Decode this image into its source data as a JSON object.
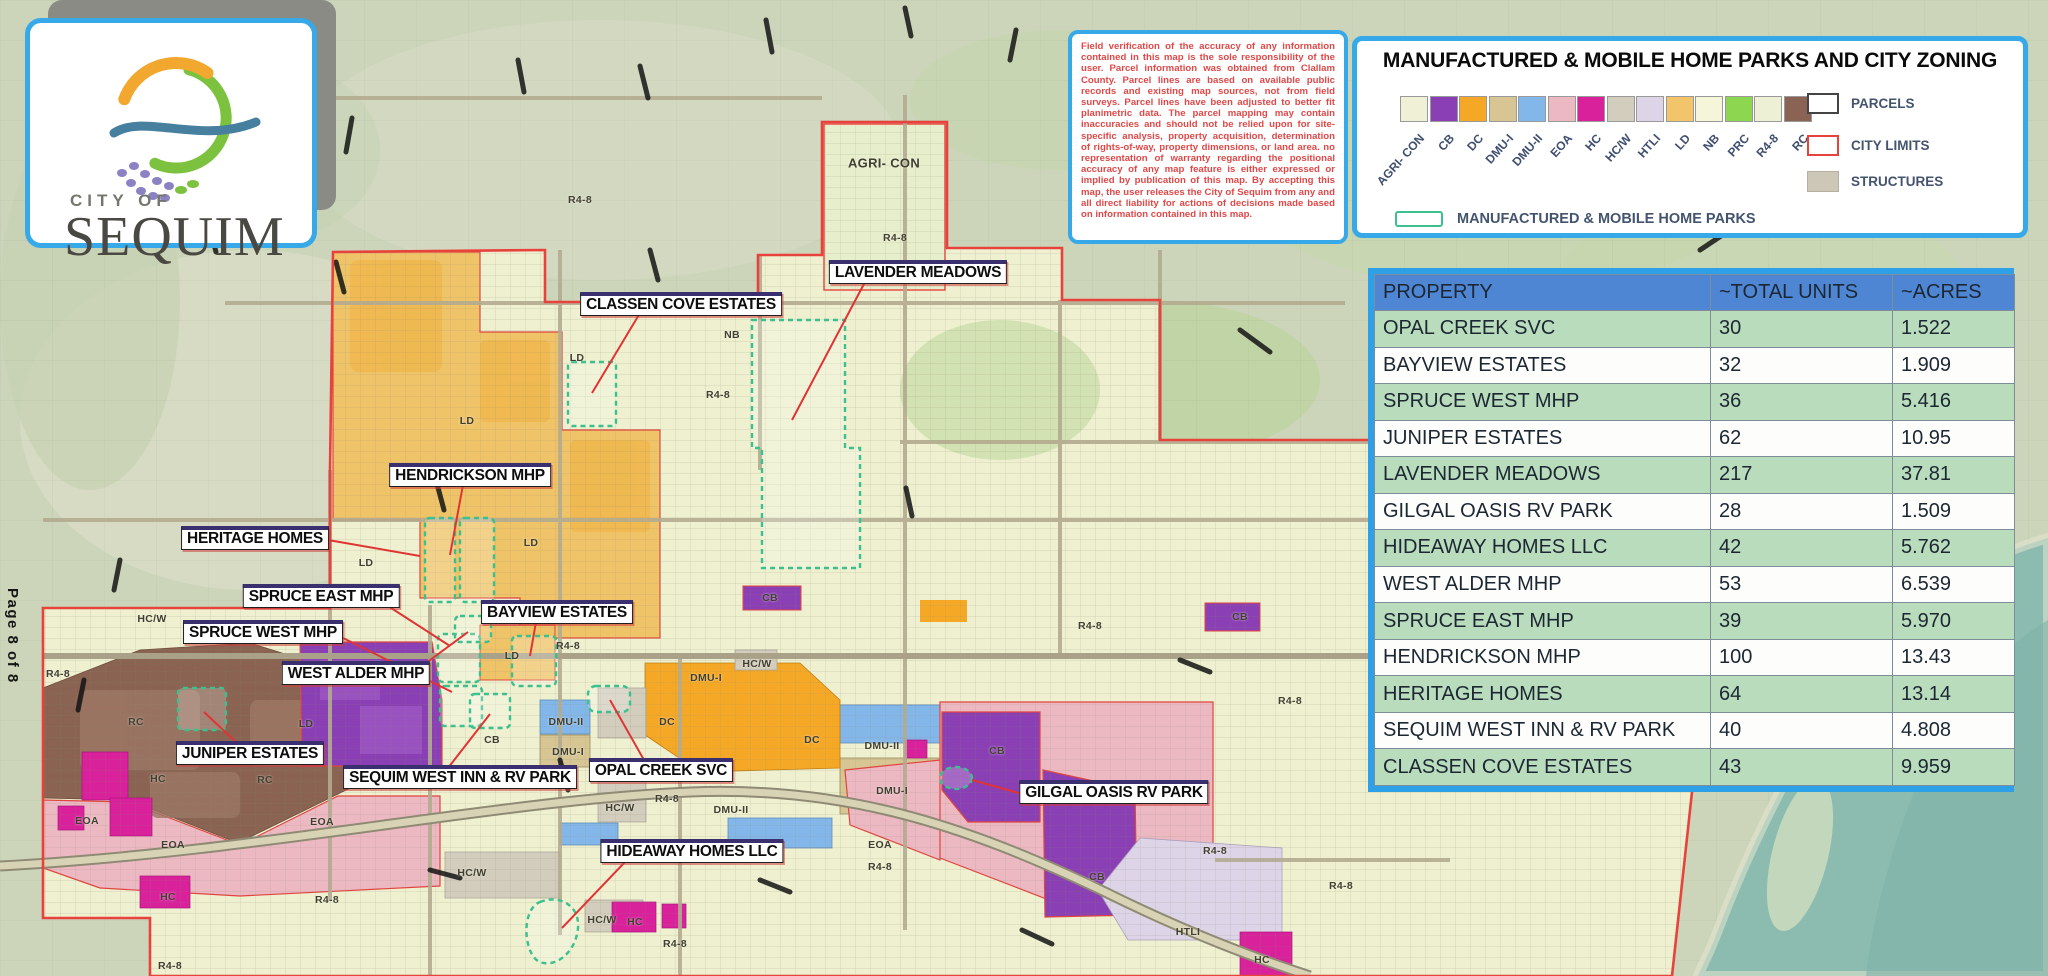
{
  "page": {
    "label": "Page 8 of 8"
  },
  "logo": {
    "line1": "CITY OF",
    "line2": "SEQUIM"
  },
  "disclaimer": {
    "text": "Field verification of the accuracy of any information contained in this map is the sole responsibility of the user.  Parcel information was obtained from Clallam County.  Parcel lines are based on available public records and existing map sources, not from field surveys.  Parcel lines have been adjusted to better fit planimetric data.   The parcel mapping may contain inaccuracies and should not be relied upon for site-specific analysis, property acquisition, determination of rights-of-way, property dimensions, or land area.  no representation of warranty regarding the positional accuracy of any map feature is either expressed or implied by publication of this map.  By accepting this map, the user releases the City of Sequim from any and all direct liability for actions of decisions made based on information contained in this map."
  },
  "legend": {
    "title": "MANUFACTURED & MOBILE HOME PARKS AND CITY ZONING",
    "zones": [
      {
        "code": "AGRI- CON",
        "color": "#eff0d6"
      },
      {
        "code": "CB",
        "color": "#8b3fb4"
      },
      {
        "code": "DC",
        "color": "#f5a826"
      },
      {
        "code": "DMU-I",
        "color": "#d7c694"
      },
      {
        "code": "DMU-II",
        "color": "#83b7e9"
      },
      {
        "code": "EOA",
        "color": "#ecb9c3"
      },
      {
        "code": "HC",
        "color": "#d9219c"
      },
      {
        "code": "HC/W",
        "color": "#d3cdbd"
      },
      {
        "code": "HTLI",
        "color": "#ddd5e7"
      },
      {
        "code": "LD",
        "color": "#f2c56a"
      },
      {
        "code": "NB",
        "color": "#f5f5da"
      },
      {
        "code": "PRC",
        "color": "#8dd650"
      },
      {
        "code": "R4-8",
        "color": "#eef0d6"
      },
      {
        "code": "RC",
        "color": "#8a6355"
      }
    ],
    "overlay_items": [
      {
        "label": "PARCELS",
        "type": "parcels"
      },
      {
        "label": "CITY LIMITS",
        "type": "city-limits"
      },
      {
        "label": "STRUCTURES",
        "type": "structures"
      }
    ],
    "mhp_item": {
      "label": "MANUFACTURED & MOBILE HOME PARKS"
    }
  },
  "table": {
    "headers": [
      "PROPERTY",
      "~TOTAL UNITS",
      "~ACRES"
    ],
    "rows": [
      [
        "OPAL CREEK SVC",
        "30",
        "1.522"
      ],
      [
        "BAYVIEW ESTATES",
        "32",
        "1.909"
      ],
      [
        "SPRUCE WEST MHP",
        "36",
        "5.416"
      ],
      [
        "JUNIPER ESTATES",
        "62",
        "10.95"
      ],
      [
        "LAVENDER MEADOWS",
        "217",
        "37.81"
      ],
      [
        "GILGAL OASIS RV PARK",
        "28",
        "1.509"
      ],
      [
        "HIDEAWAY HOMES LLC",
        "42",
        "5.762"
      ],
      [
        "WEST ALDER MHP",
        "53",
        "6.539"
      ],
      [
        "SPRUCE EAST MHP",
        "39",
        "5.970"
      ],
      [
        "HENDRICKSON MHP",
        "100",
        "13.43"
      ],
      [
        "HERITAGE HOMES",
        "64",
        "13.14"
      ],
      [
        "SEQUIM WEST INN & RV PARK",
        "40",
        "4.808"
      ],
      [
        "CLASSEN COVE ESTATES",
        "43",
        "9.959"
      ]
    ]
  },
  "map": {
    "park_labels": [
      {
        "text": "CLASSEN COVE ESTATES",
        "x": 681,
        "y": 304,
        "leader": [
          640,
          313,
          592,
          393
        ]
      },
      {
        "text": "LAVENDER MEADOWS",
        "x": 918,
        "y": 272,
        "leader": [
          865,
          282,
          792,
          420
        ]
      },
      {
        "text": "HENDRICKSON MHP",
        "x": 470,
        "y": 475,
        "leader": [
          463,
          485,
          450,
          555
        ]
      },
      {
        "text": "HERITAGE HOMES",
        "x": 255,
        "y": 538,
        "leader": [
          328,
          540,
          420,
          556
        ]
      },
      {
        "text": "SPRUCE EAST MHP",
        "x": 321,
        "y": 596,
        "leader": [
          388,
          606,
          450,
          646
        ]
      },
      {
        "text": "BAYVIEW ESTATES",
        "x": 557,
        "y": 612,
        "leader": [
          536,
          622,
          530,
          656
        ]
      },
      {
        "text": "SPRUCE WEST MHP",
        "x": 263,
        "y": 632,
        "leader": [
          343,
          638,
          452,
          692
        ]
      },
      {
        "text": "WEST ALDER MHP",
        "x": 356,
        "y": 673,
        "leader": [
          422,
          666,
          468,
          632
        ]
      },
      {
        "text": "JUNIPER ESTATES",
        "x": 250,
        "y": 753,
        "leader": [
          238,
          744,
          204,
          712
        ]
      },
      {
        "text": "SEQUIM WEST INN & RV PARK",
        "x": 460,
        "y": 777,
        "leader": [
          448,
          768,
          490,
          714
        ]
      },
      {
        "text": "OPAL CREEK SVC",
        "x": 661,
        "y": 770,
        "leader": [
          644,
          760,
          610,
          700
        ]
      },
      {
        "text": "HIDEAWAY HOMES LLC",
        "x": 692,
        "y": 851,
        "leader": [
          625,
          862,
          562,
          928
        ]
      },
      {
        "text": "GILGAL OASIS RV PARK",
        "x": 1114,
        "y": 792,
        "leader": [
          1022,
          794,
          972,
          780
        ]
      }
    ],
    "zone_labels": [
      {
        "text": "AGRI- CON",
        "x": 884,
        "y": 163,
        "size": 13
      },
      {
        "text": "R4-8",
        "x": 580,
        "y": 200
      },
      {
        "text": "R4-8",
        "x": 895,
        "y": 238
      },
      {
        "text": "R4-8",
        "x": 718,
        "y": 395
      },
      {
        "text": "R4-8",
        "x": 568,
        "y": 646
      },
      {
        "text": "R4-8",
        "x": 667,
        "y": 799
      },
      {
        "text": "R4-8",
        "x": 58,
        "y": 674
      },
      {
        "text": "R4-8",
        "x": 1090,
        "y": 626
      },
      {
        "text": "R4-8",
        "x": 1290,
        "y": 701
      },
      {
        "text": "R4-8",
        "x": 1215,
        "y": 851
      },
      {
        "text": "R4-8",
        "x": 1341,
        "y": 886
      },
      {
        "text": "R4-8",
        "x": 880,
        "y": 867
      },
      {
        "text": "R4-8",
        "x": 675,
        "y": 944
      },
      {
        "text": "R4-8",
        "x": 327,
        "y": 900
      },
      {
        "text": "R4-8",
        "x": 170,
        "y": 966
      },
      {
        "text": "LD",
        "x": 577,
        "y": 358
      },
      {
        "text": "LD",
        "x": 467,
        "y": 421
      },
      {
        "text": "LD",
        "x": 366,
        "y": 563
      },
      {
        "text": "LD",
        "x": 531,
        "y": 543
      },
      {
        "text": "LD",
        "x": 306,
        "y": 724
      },
      {
        "text": "LD",
        "x": 512,
        "y": 656
      },
      {
        "text": "NB",
        "x": 732,
        "y": 335
      },
      {
        "text": "HC/W",
        "x": 152,
        "y": 619
      },
      {
        "text": "HC/W",
        "x": 757,
        "y": 664
      },
      {
        "text": "HC/W",
        "x": 620,
        "y": 808
      },
      {
        "text": "HC/W",
        "x": 472,
        "y": 873
      },
      {
        "text": "HC/W",
        "x": 602,
        "y": 920
      },
      {
        "text": "DMU-I",
        "x": 706,
        "y": 678
      },
      {
        "text": "DMU-I",
        "x": 568,
        "y": 752
      },
      {
        "text": "DMU-I",
        "x": 892,
        "y": 791
      },
      {
        "text": "DMU-II",
        "x": 566,
        "y": 722
      },
      {
        "text": "DMU-II",
        "x": 882,
        "y": 746
      },
      {
        "text": "DMU-II",
        "x": 731,
        "y": 810
      },
      {
        "text": "DC",
        "x": 667,
        "y": 722
      },
      {
        "text": "DC",
        "x": 812,
        "y": 740
      },
      {
        "text": "CB",
        "x": 492,
        "y": 740
      },
      {
        "text": "CB",
        "x": 770,
        "y": 598
      },
      {
        "text": "CB",
        "x": 997,
        "y": 751
      },
      {
        "text": "CB",
        "x": 1097,
        "y": 877
      },
      {
        "text": "CB",
        "x": 1240,
        "y": 617
      },
      {
        "text": "EOA",
        "x": 87,
        "y": 821
      },
      {
        "text": "EOA",
        "x": 322,
        "y": 822
      },
      {
        "text": "EOA",
        "x": 173,
        "y": 845
      },
      {
        "text": "EOA",
        "x": 880,
        "y": 845
      },
      {
        "text": "HC",
        "x": 158,
        "y": 779
      },
      {
        "text": "HC",
        "x": 168,
        "y": 897
      },
      {
        "text": "HC",
        "x": 635,
        "y": 922
      },
      {
        "text": "HC",
        "x": 1262,
        "y": 960
      },
      {
        "text": "RC",
        "x": 136,
        "y": 722
      },
      {
        "text": "RC",
        "x": 265,
        "y": 780
      },
      {
        "text": "HTLI",
        "x": 1188,
        "y": 932
      }
    ]
  },
  "colors": {
    "accent_blue": "#38a9e8",
    "table_header_blue": "#4e86d4",
    "table_row_green": "#b9dcbd",
    "city_limit_red": "#e8423c",
    "park_outline_teal": "#3cc08d",
    "leader_red": "#e03434",
    "disclaimer_red": "#e04848",
    "water_teal": "#8cbcb0"
  }
}
